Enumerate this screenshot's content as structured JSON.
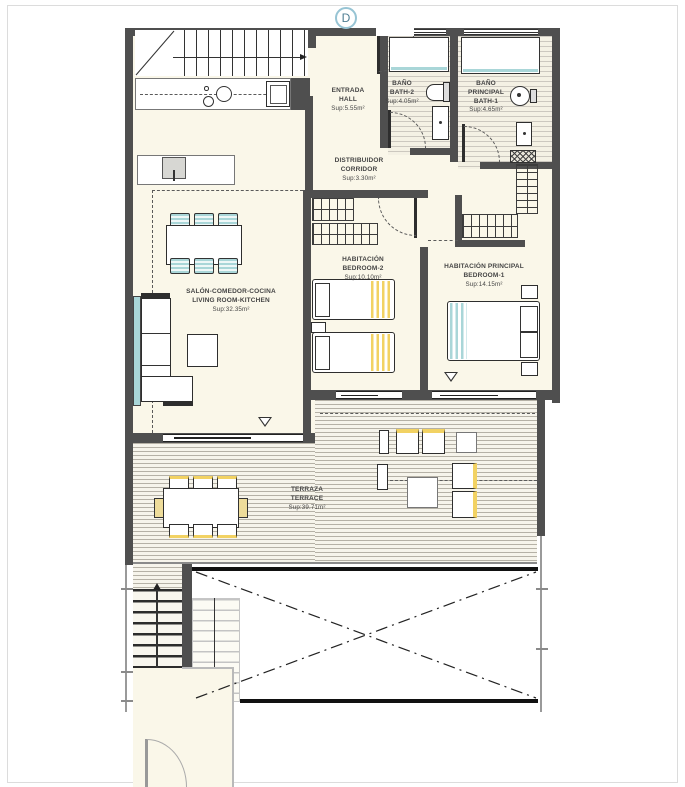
{
  "marker": {
    "label": "D"
  },
  "rooms": {
    "hall": {
      "lines": [
        "ENTRADA",
        "HALL"
      ],
      "area": "Sup:5.55m²"
    },
    "bath2": {
      "lines": [
        "BAÑO",
        "BATH-2"
      ],
      "area": "Sup:4.05m²"
    },
    "bath1": {
      "lines": [
        "BAÑO PRINCIPAL",
        "BATH-1"
      ],
      "area": "Sup:4.65m²"
    },
    "corridor": {
      "lines": [
        "DISTRIBUIDOR",
        "CORRIDOR"
      ],
      "area": "Sup:3.30m²"
    },
    "bedroom2": {
      "lines": [
        "HABITACIÓN",
        "BEDROOM-2"
      ],
      "area": "Sup:10.10m²"
    },
    "bedroom1": {
      "lines": [
        "HABITACIÓN PRINCIPAL",
        "BEDROOM-1"
      ],
      "area": "Sup:14.15m²"
    },
    "living": {
      "lines": [
        "SALÓN-COMEDOR-COCINA",
        "LIVING ROOM-KITCHEN"
      ],
      "area": "Sup:32.35m²"
    },
    "terrace": {
      "lines": [
        "TERRAZA",
        "TERRACE"
      ],
      "area": "Sup:39.71m²"
    }
  },
  "colors": {
    "wall": "#4f4f4f",
    "floor": "#faf7e9",
    "accent_teal": "#a9d6d8",
    "accent_yellow": "#f2d263",
    "marker_ring": "#97c4d4"
  }
}
